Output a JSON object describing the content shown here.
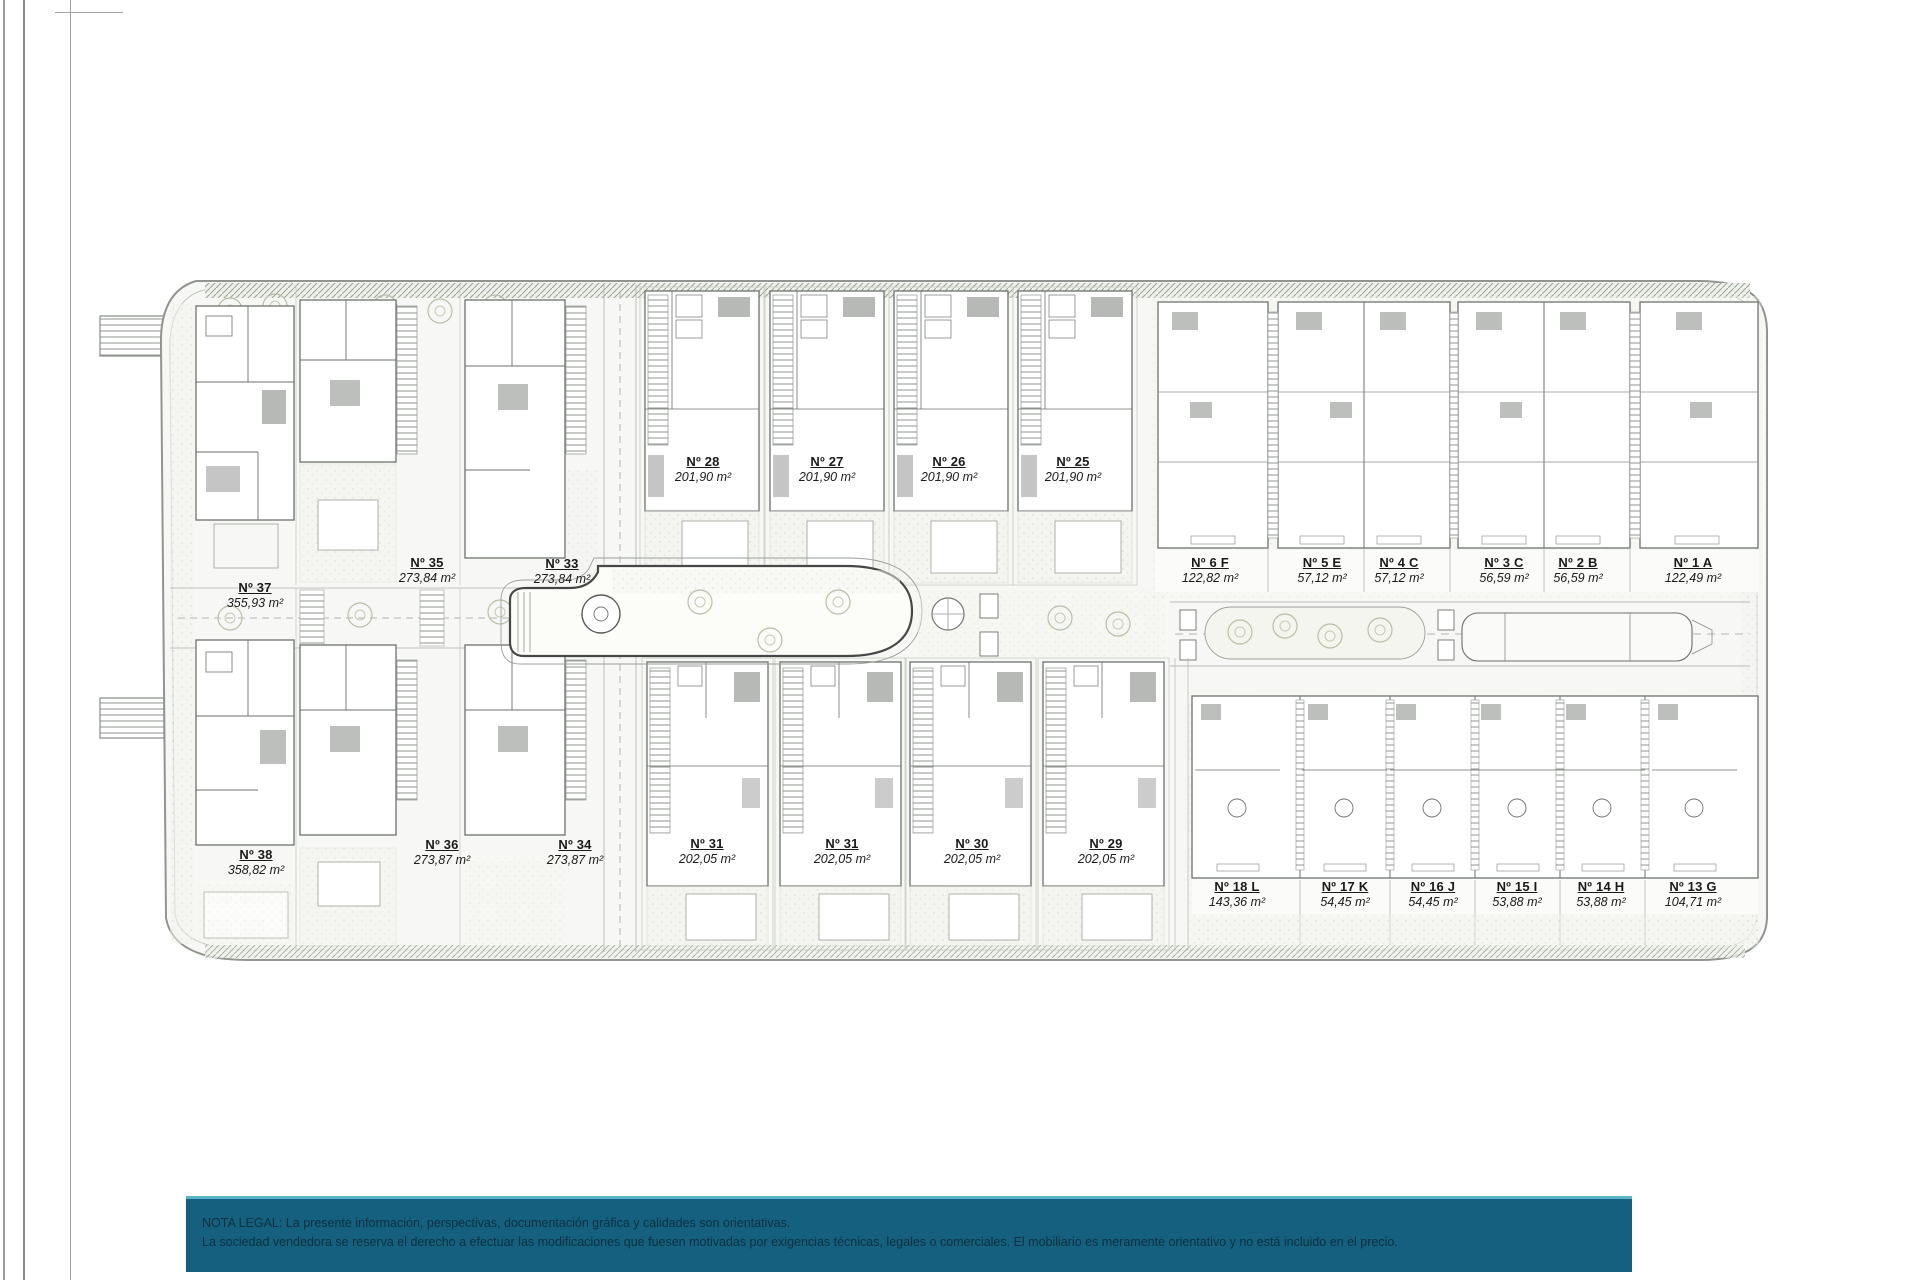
{
  "plan": {
    "units": [
      {
        "name": "Nº 37",
        "area": "355,93 m²",
        "x": 255,
        "y": 581
      },
      {
        "name": "Nº 35",
        "area": "273,84 m²",
        "x": 427,
        "y": 556
      },
      {
        "name": "Nº 33",
        "area": "273,84 m²",
        "x": 562,
        "y": 557
      },
      {
        "name": "Nº 28",
        "area": "201,90 m²",
        "x": 703,
        "y": 455
      },
      {
        "name": "Nº 27",
        "area": "201,90 m²",
        "x": 827,
        "y": 455
      },
      {
        "name": "Nº 26",
        "area": "201,90 m²",
        "x": 949,
        "y": 455
      },
      {
        "name": "Nº 25",
        "area": "201,90 m²",
        "x": 1073,
        "y": 455
      },
      {
        "name": "Nº 6 F",
        "area": "122,82 m²",
        "x": 1210,
        "y": 556
      },
      {
        "name": "Nº 5 E",
        "area": "57,12 m²",
        "x": 1322,
        "y": 556
      },
      {
        "name": "Nº 4 C",
        "area": "57,12 m²",
        "x": 1399,
        "y": 556
      },
      {
        "name": "Nº 3 C",
        "area": "56,59 m²",
        "x": 1504,
        "y": 556
      },
      {
        "name": "Nº 2 B",
        "area": "56,59 m²",
        "x": 1578,
        "y": 556
      },
      {
        "name": "Nº 1 A",
        "area": "122,49 m²",
        "x": 1693,
        "y": 556
      },
      {
        "name": "Nº 38",
        "area": "358,82 m²",
        "x": 256,
        "y": 848
      },
      {
        "name": "Nº 36",
        "area": "273,87 m²",
        "x": 442,
        "y": 838
      },
      {
        "name": "Nº 34",
        "area": "273,87 m²",
        "x": 575,
        "y": 838
      },
      {
        "name": "Nº 31",
        "area": "202,05 m²",
        "x": 707,
        "y": 837
      },
      {
        "name": "Nº 31",
        "area": "202,05 m²",
        "x": 842,
        "y": 837
      },
      {
        "name": "Nº 30",
        "area": "202,05 m²",
        "x": 972,
        "y": 837
      },
      {
        "name": "Nº 29",
        "area": "202,05 m²",
        "x": 1106,
        "y": 837
      },
      {
        "name": "Nº 18 L",
        "area": "143,36 m²",
        "x": 1237,
        "y": 880
      },
      {
        "name": "Nº 17 K",
        "area": "54,45 m²",
        "x": 1345,
        "y": 880
      },
      {
        "name": "Nº 16 J",
        "area": "54,45 m²",
        "x": 1433,
        "y": 880
      },
      {
        "name": "Nº 15 I",
        "area": "53,88 m²",
        "x": 1517,
        "y": 880
      },
      {
        "name": "Nº 14 H",
        "area": "53,88 m²",
        "x": 1601,
        "y": 880
      },
      {
        "name": "Nº 13 G",
        "area": "104,71 m²",
        "x": 1693,
        "y": 880
      }
    ]
  },
  "legal": {
    "line1": "NOTA LEGAL: La presente información, perspectivas, documentación gráfica y calidades son orientativas.",
    "line2": "La sociedad vendedora se reserva el derecho a efectuar las modificaciones que fuesen motivadas por exigencias técnicas, legales o comerciales. El mobiliario es meramente orientativo y no está incluido en el precio."
  },
  "colors": {
    "legal_bar_background": "#15607e",
    "legal_bar_top_border": "#5ab5c8",
    "legal_text": "#0c3040",
    "plan_lines": "#6d726d",
    "site_fill": "#f7f8f5",
    "site_boundary": "#90958f",
    "unit_label_text": "#1a1a1a"
  }
}
